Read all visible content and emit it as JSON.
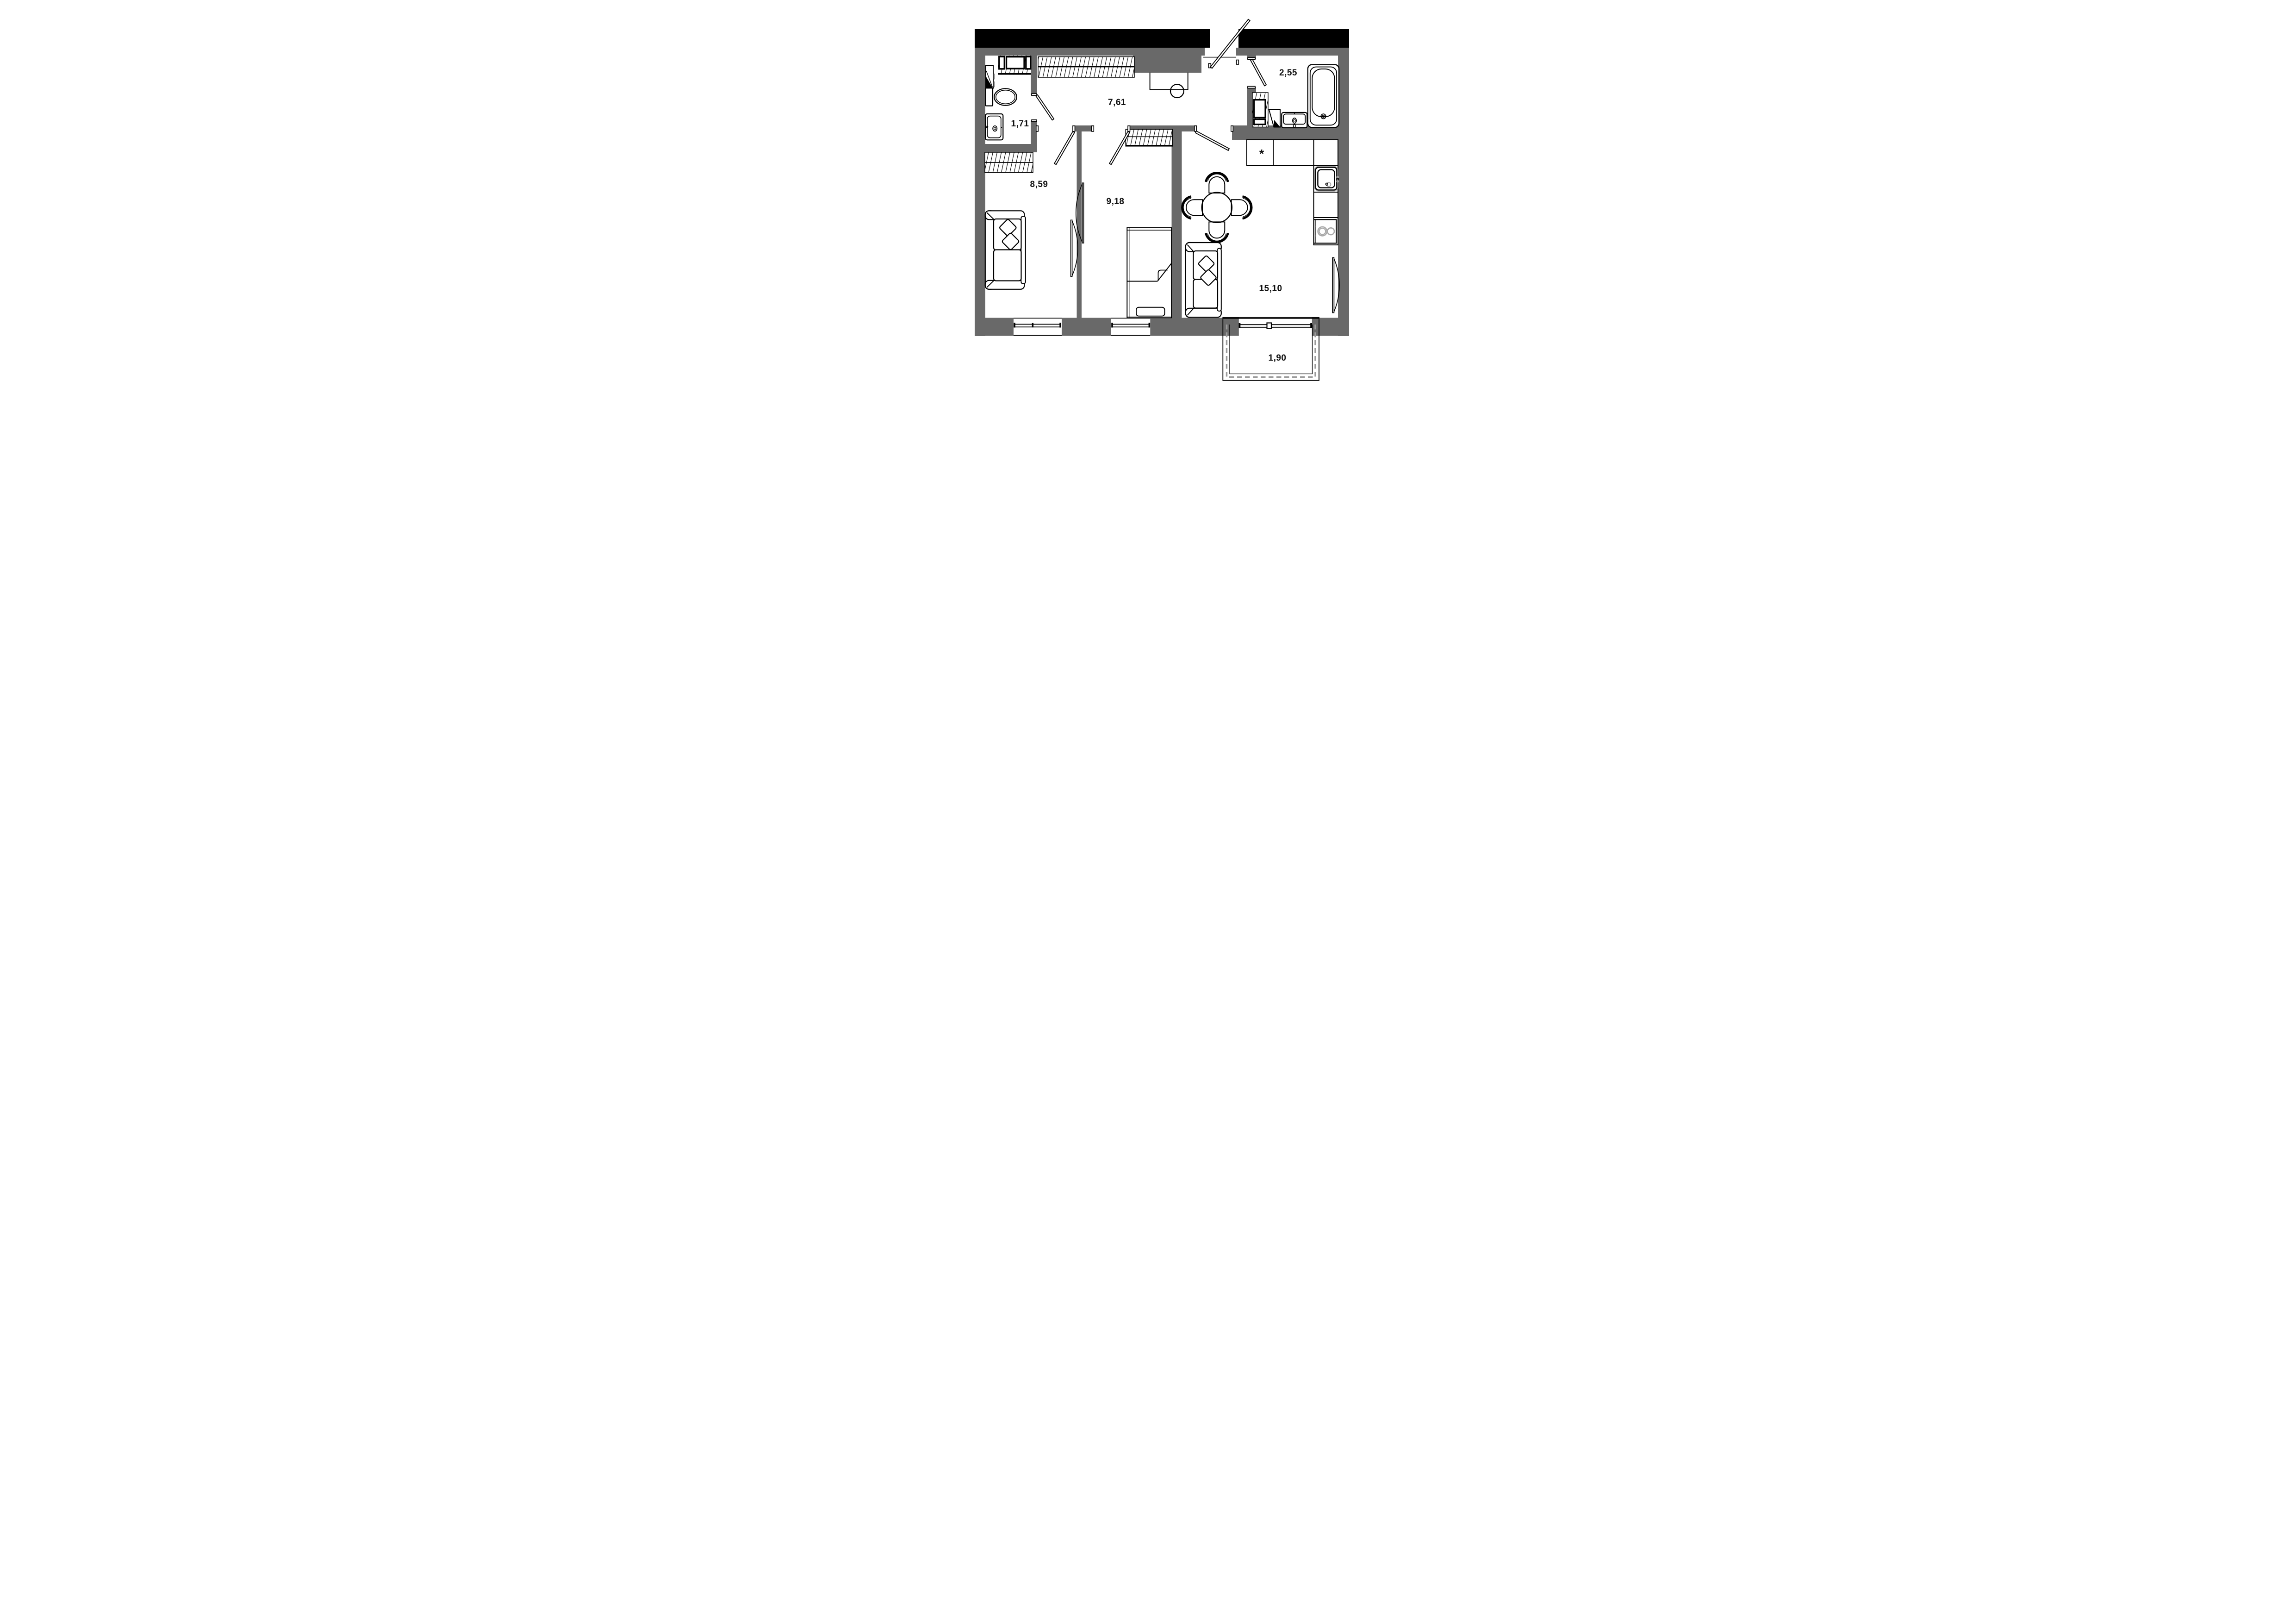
{
  "plan": {
    "title": "2-room apartment floor plan",
    "rooms": [
      {
        "id": "wc",
        "name": "toilet room",
        "area": "1,71"
      },
      {
        "id": "hallway",
        "name": "hallway",
        "area": "7,61"
      },
      {
        "id": "bathroom",
        "name": "bathroom",
        "area": "2,55"
      },
      {
        "id": "room-left",
        "name": "living room left",
        "area": "8,59"
      },
      {
        "id": "room-middle",
        "name": "bedroom",
        "area": "9,18"
      },
      {
        "id": "kitchen-living",
        "name": "kitchen-living room",
        "area": "15,10"
      },
      {
        "id": "balcony",
        "name": "balcony",
        "area": "1,90"
      }
    ],
    "symbols": {
      "fridge": "*"
    },
    "colors": {
      "wall": "#696969",
      "outer": "#000000",
      "line": "#000000",
      "glazing_dash": "#9b9b9b",
      "appliance": "#a9a9a9",
      "bg": "#ffffff"
    }
  }
}
